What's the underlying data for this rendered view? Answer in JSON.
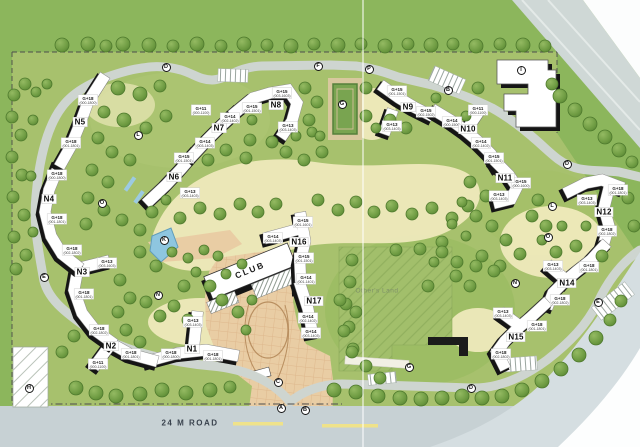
{
  "site_plan": {
    "road_label": "24 M ROAD",
    "club_label": "CLUB",
    "others_land_label": "Other's Land",
    "colors": {
      "lawn": "#a7c16d",
      "outer_green": "#8cb65c",
      "path_cream": "#efeabc",
      "road_grey": "#ced5d0",
      "plaza_tan": "#e9cda4",
      "water_blue": "#8ec6e0",
      "tree_green": "#6f9c43",
      "building_white": "#ffffff",
      "building_shadow": "#151515"
    },
    "towers": [
      {
        "name": "N1",
        "x": 192,
        "y": 349,
        "wings": [
          {
            "floors": "G+13",
            "units": "(003-1403)",
            "x": 193,
            "y": 322
          },
          {
            "floors": "G+18",
            "units": "(000-1800)",
            "x": 171,
            "y": 354
          },
          {
            "floors": "G+18",
            "units": "(001-1801)",
            "x": 213,
            "y": 356
          }
        ]
      },
      {
        "name": "N2",
        "x": 111,
        "y": 346,
        "wings": [
          {
            "floors": "G+18",
            "units": "(001-1801)",
            "x": 131,
            "y": 354
          },
          {
            "floors": "G+11",
            "units": "(000-1100)",
            "x": 98,
            "y": 364
          }
        ]
      },
      {
        "name": "N3",
        "x": 82,
        "y": 272,
        "wings": [
          {
            "floors": "G+13",
            "units": "(003-1603)",
            "x": 107,
            "y": 263
          },
          {
            "floors": "G+18",
            "units": "(001-1801)",
            "x": 84,
            "y": 294
          },
          {
            "floors": "G+18",
            "units": "(002-1802)",
            "x": 99,
            "y": 330
          }
        ]
      },
      {
        "name": "N4",
        "x": 49,
        "y": 199,
        "wings": [
          {
            "floors": "G+18",
            "units": "(000-1800)",
            "x": 57,
            "y": 175
          },
          {
            "floors": "G+18",
            "units": "(001-1801)",
            "x": 57,
            "y": 219
          },
          {
            "floors": "G+18",
            "units": "(002-1802)",
            "x": 72,
            "y": 250
          }
        ]
      },
      {
        "name": "N5",
        "x": 80,
        "y": 122,
        "wings": [
          {
            "floors": "G+18",
            "units": "(000-1800)",
            "x": 88,
            "y": 100
          },
          {
            "floors": "G+18",
            "units": "(001-1801)",
            "x": 71,
            "y": 143
          }
        ]
      },
      {
        "name": "N6",
        "x": 174,
        "y": 177,
        "wings": [
          {
            "floors": "G+15",
            "units": "(001-1501)",
            "x": 184,
            "y": 158
          },
          {
            "floors": "G+13",
            "units": "(003-1403)",
            "x": 190,
            "y": 193
          }
        ]
      },
      {
        "name": "N7",
        "x": 219,
        "y": 128,
        "wings": [
          {
            "floors": "G+11",
            "units": "(000-1100)",
            "x": 201,
            "y": 110
          },
          {
            "floors": "G+14",
            "units": "(002-1402)",
            "x": 230,
            "y": 118
          },
          {
            "floors": "G+14",
            "units": "(003-1403)",
            "x": 205,
            "y": 143
          }
        ]
      },
      {
        "name": "N8",
        "x": 276,
        "y": 105,
        "wings": [
          {
            "floors": "G+15",
            "units": "(003-1603)",
            "x": 282,
            "y": 93
          },
          {
            "floors": "G+15",
            "units": "(001-1501)",
            "x": 252,
            "y": 108
          },
          {
            "floors": "G+13",
            "units": "(003-1403)",
            "x": 288,
            "y": 127
          }
        ]
      },
      {
        "name": "N9",
        "x": 408,
        "y": 107,
        "wings": [
          {
            "floors": "G+15",
            "units": "(001-1501)",
            "x": 397,
            "y": 91
          },
          {
            "floors": "G+15",
            "units": "(002-1502)",
            "x": 426,
            "y": 112
          },
          {
            "floors": "G+13",
            "units": "(003-1403)",
            "x": 392,
            "y": 126
          }
        ]
      },
      {
        "name": "N10",
        "x": 468,
        "y": 129,
        "wings": [
          {
            "floors": "G+11",
            "units": "(000-1100)",
            "x": 478,
            "y": 110
          },
          {
            "floors": "G+14",
            "units": "(000-1500)",
            "x": 452,
            "y": 122
          },
          {
            "floors": "G+14",
            "units": "(002-1402)",
            "x": 481,
            "y": 143
          },
          {
            "floors": "G+15",
            "units": "(001-1501)",
            "x": 494,
            "y": 158
          }
        ]
      },
      {
        "name": "N11",
        "x": 505,
        "y": 178,
        "wings": [
          {
            "floors": "G+15",
            "units": "(000-1600)",
            "x": 521,
            "y": 183
          },
          {
            "floors": "G+13",
            "units": "(003-1403)",
            "x": 499,
            "y": 196
          }
        ]
      },
      {
        "name": "N12",
        "x": 604,
        "y": 212,
        "wings": [
          {
            "floors": "G+18",
            "units": "(001-1801)",
            "x": 618,
            "y": 190
          },
          {
            "floors": "G+13",
            "units": "(003-1403)",
            "x": 587,
            "y": 200
          },
          {
            "floors": "G+18",
            "units": "(002-1802)",
            "x": 607,
            "y": 231
          }
        ]
      },
      {
        "name": "N14",
        "x": 567,
        "y": 283,
        "wings": [
          {
            "floors": "G+13",
            "units": "(003-1403)",
            "x": 553,
            "y": 266
          },
          {
            "floors": "G+18",
            "units": "(001-1801)",
            "x": 589,
            "y": 267
          },
          {
            "floors": "G+18",
            "units": "(002-1802)",
            "x": 560,
            "y": 300
          }
        ]
      },
      {
        "name": "N15",
        "x": 516,
        "y": 337,
        "wings": [
          {
            "floors": "G+13",
            "units": "(003-1403)",
            "x": 503,
            "y": 313
          },
          {
            "floors": "G+18",
            "units": "(001-1801)",
            "x": 537,
            "y": 326
          },
          {
            "floors": "G+18",
            "units": "(002-1802)",
            "x": 501,
            "y": 354
          }
        ]
      },
      {
        "name": "N16",
        "x": 299,
        "y": 242,
        "wings": [
          {
            "floors": "G+15",
            "units": "(001-1601)",
            "x": 303,
            "y": 222
          },
          {
            "floors": "G+14",
            "units": "(003-1403)",
            "x": 273,
            "y": 238
          },
          {
            "floors": "G+15",
            "units": "(001-1501)",
            "x": 304,
            "y": 258
          },
          {
            "floors": "G+14",
            "units": "(001-1401)",
            "x": 306,
            "y": 279
          }
        ]
      },
      {
        "name": "N17",
        "x": 314,
        "y": 301,
        "wings": [
          {
            "floors": "G+14",
            "units": "(002-1402)",
            "x": 308,
            "y": 318
          },
          {
            "floors": "G+14",
            "units": "(003-1403)",
            "x": 311,
            "y": 333
          }
        ]
      }
    ],
    "markers": [
      {
        "letter": "D",
        "x": 166,
        "y": 67
      },
      {
        "letter": "F",
        "x": 318,
        "y": 66
      },
      {
        "letter": "P",
        "x": 369,
        "y": 69
      },
      {
        "letter": "B",
        "x": 448,
        "y": 90
      },
      {
        "letter": "I",
        "x": 521,
        "y": 70
      },
      {
        "letter": "D",
        "x": 567,
        "y": 164
      },
      {
        "letter": "L",
        "x": 552,
        "y": 206
      },
      {
        "letter": "O",
        "x": 548,
        "y": 237
      },
      {
        "letter": "N",
        "x": 515,
        "y": 283
      },
      {
        "letter": "E",
        "x": 598,
        "y": 302
      },
      {
        "letter": "G",
        "x": 409,
        "y": 367
      },
      {
        "letter": "D",
        "x": 471,
        "y": 388
      },
      {
        "letter": "C",
        "x": 278,
        "y": 382
      },
      {
        "letter": "A",
        "x": 281,
        "y": 408
      },
      {
        "letter": "B",
        "x": 305,
        "y": 410
      },
      {
        "letter": "H",
        "x": 29,
        "y": 388
      },
      {
        "letter": "E",
        "x": 44,
        "y": 277
      },
      {
        "letter": "L",
        "x": 138,
        "y": 135
      },
      {
        "letter": "O",
        "x": 102,
        "y": 203
      },
      {
        "letter": "K",
        "x": 164,
        "y": 240
      },
      {
        "letter": "N",
        "x": 158,
        "y": 295
      },
      {
        "letter": "G",
        "x": 342,
        "y": 104
      }
    ]
  }
}
